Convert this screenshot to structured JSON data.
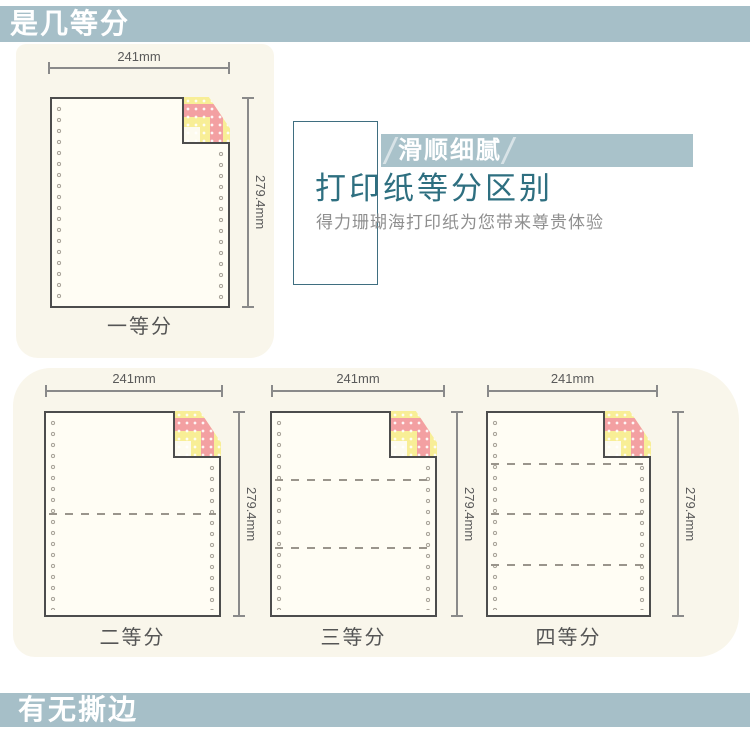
{
  "header_bar": {
    "label": "是几等分"
  },
  "footer_bar": {
    "label": "有无撕边"
  },
  "info_panel": {
    "badge_label": "滑顺细腻",
    "title": "打印纸等分区别",
    "subtitle": "得力珊瑚海打印纸为您带来尊贵体验"
  },
  "diagrams": [
    {
      "caption": "一等分",
      "width_label": "241mm",
      "height_label": "279.4mm",
      "divisions": 1
    },
    {
      "caption": "二等分",
      "width_label": "241mm",
      "height_label": "279.4mm",
      "divisions": 2
    },
    {
      "caption": "三等分",
      "width_label": "241mm",
      "height_label": "279.4mm",
      "divisions": 3
    },
    {
      "caption": "四等分",
      "width_label": "241mm",
      "height_label": "279.4mm",
      "divisions": 4
    }
  ],
  "colors": {
    "bar_bg": "#a6bfc8",
    "banner_bg": "#a9c2ca",
    "blob_bg": "#f9f6eb",
    "paper_bg": "#fffdf4",
    "paper_border": "#4d4d4d",
    "title_teal": "#2e6f80",
    "fold_pink": "#f3a0a2",
    "fold_yellow": "#f8ee96"
  }
}
